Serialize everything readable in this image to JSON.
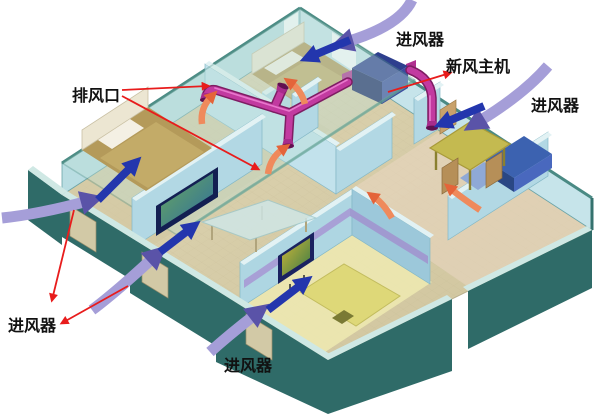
{
  "labels": {
    "exhaust_outlet": {
      "text": "排风口"
    },
    "air_inlet_top": {
      "text": "进风器"
    },
    "fresh_air_unit": {
      "text": "新风主机"
    },
    "air_inlet_right": {
      "text": "进风器"
    },
    "air_inlet_bottom_left": {
      "text": "进风器"
    },
    "air_inlet_bottom_center": {
      "text": "进风器"
    }
  },
  "colors": {
    "background": "#ffffff",
    "outer_wall": "#2f6b68",
    "inner_wall": "#b2d8e4",
    "floor": "#d8cfad",
    "ceiling_glass": "#bfe0d6",
    "duct_magenta": "#c23aa0",
    "main_unit_navy": "#2e3f8e",
    "supply_arrow_outdoor": "#a59ed8",
    "supply_arrow_indoor": "#2336ad",
    "exhaust_arrow": "#ef8a5c",
    "annotation_red": "#e81c1c",
    "label_text": "#111111"
  },
  "airflows": {
    "outdoor_supply": {
      "color": "#a59ed8",
      "width": 11,
      "marker": "lav",
      "paths": [
        {
          "name": "outdoor-air-arrow-top",
          "d": "M412,0 Q400,26 346,42"
        },
        {
          "name": "outdoor-air-arrow-right",
          "d": "M548,66 Q524,94 478,122"
        },
        {
          "name": "outdoor-air-arrow-left",
          "d": "M2,218 Q40,214 88,201"
        },
        {
          "name": "outdoor-air-arrow-living",
          "d": "M92,310 Q116,292 154,257"
        },
        {
          "name": "outdoor-air-arrow-bottom",
          "d": "M210,352 Q230,334 256,314"
        }
      ]
    },
    "indoor_supply": {
      "color": "#2336ad",
      "width": 8,
      "marker": "blue",
      "paths": [
        {
          "name": "indoor-air-arrow-top-bedroom",
          "d": "M350,40 L312,56"
        },
        {
          "name": "indoor-air-arrow-dining",
          "d": "M484,106 L446,122"
        },
        {
          "name": "indoor-air-arrow-left-bedroom",
          "d": "M98,200 L132,166"
        },
        {
          "name": "indoor-air-arrow-living",
          "d": "M160,252 L190,229"
        },
        {
          "name": "indoor-air-arrow-bottom-bedroom",
          "d": "M268,310 L302,284"
        }
      ]
    },
    "exhaust": {
      "color": "#ef8a5c",
      "width": 6.5,
      "marker": "sal",
      "paths": [
        {
          "name": "exhaust-air-arrow-left",
          "d": "M202,124 Q200,108 211,97"
        },
        {
          "name": "exhaust-air-arrow-center",
          "d": "M268,174 Q270,158 283,149"
        },
        {
          "name": "exhaust-air-arrow-top-bedroom",
          "d": "M305,104 Q301,90 291,83"
        },
        {
          "name": "exhaust-air-arrow-hall",
          "d": "M392,218 Q384,204 374,197"
        },
        {
          "name": "exhaust-air-arrow-dining",
          "d": "M480,210 Q462,198 451,189"
        }
      ]
    }
  },
  "annotations": {
    "color": "#e81c1c",
    "width": 1.8,
    "marker": "red",
    "paths": [
      {
        "name": "pointer-exhaust-outlet-1",
        "d": "M122,90 L208,86"
      },
      {
        "name": "pointer-exhaust-outlet-2",
        "d": "M122,96 L258,169"
      },
      {
        "name": "pointer-inlet-left-1",
        "d": "M74,210 L52,300"
      },
      {
        "name": "pointer-inlet-left-2",
        "d": "M128,286 L62,323"
      },
      {
        "name": "pointer-fresh-air-unit",
        "d": "M388,92 L450,73"
      }
    ]
  }
}
